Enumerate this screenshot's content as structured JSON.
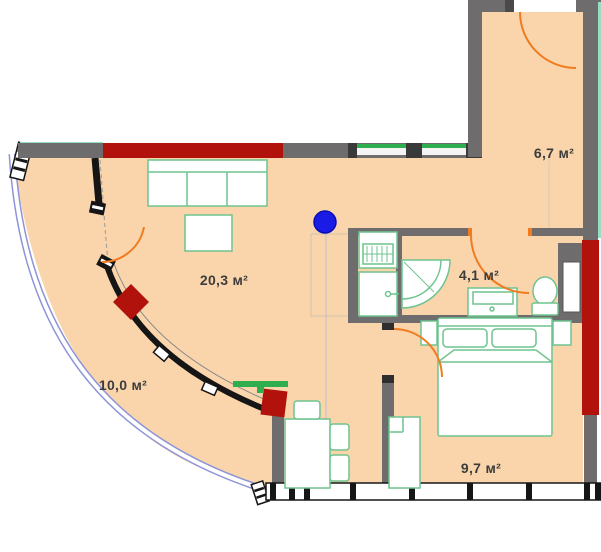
{
  "plan": {
    "type": "apartment-floor-plan",
    "rooms": {
      "living": {
        "area_label": "20,3 м²"
      },
      "balcony": {
        "area_label": "10,0 м²"
      },
      "hallway": {
        "area_label": "6,7 м²"
      },
      "bathroom": {
        "area_label": "4,1 м²"
      },
      "bedroom": {
        "area_label": "9,7 м²"
      }
    },
    "colors": {
      "floor": "#fad5ac",
      "wall_gray": "#6e6c6c",
      "accent_red": "#b2120c",
      "door_orange": "#f07b20",
      "furniture_green": "#6fc48f",
      "glass_green": "#2fae4f",
      "glazing_blue": "#8d94d8",
      "teal_edge": "#9adcc0",
      "marker_blue": "#1b1be6",
      "label_text": "#3c3c3c"
    },
    "marker": {
      "shape": "dot",
      "color": "#1b1be6"
    }
  }
}
